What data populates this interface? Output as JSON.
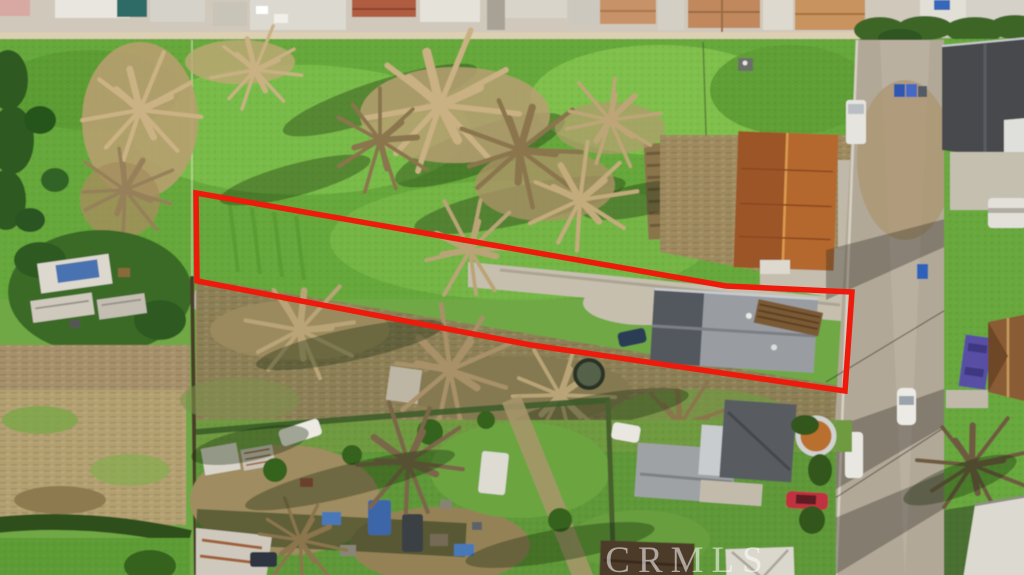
{
  "watermark": {
    "text": "CRMLS"
  },
  "parcel_outline": {
    "points": "196,193 726,286 852,292 845,391 531,345 197,281",
    "color": "#ee1b0d",
    "width": "5.5"
  },
  "scene": {
    "type": "aerial-drone-photo",
    "palette": {
      "grass": "#67a93a",
      "dry_brush": "#b59d72",
      "dirt": "#9c8a5f",
      "road": "#b2a897",
      "concrete": "#c5beae",
      "roof_gray": "#9a9da0",
      "roof_orange": "#b4672e",
      "boundary_red": "#ee1b0d",
      "watermark_white": "rgba(255,255,255,0.55)"
    }
  }
}
